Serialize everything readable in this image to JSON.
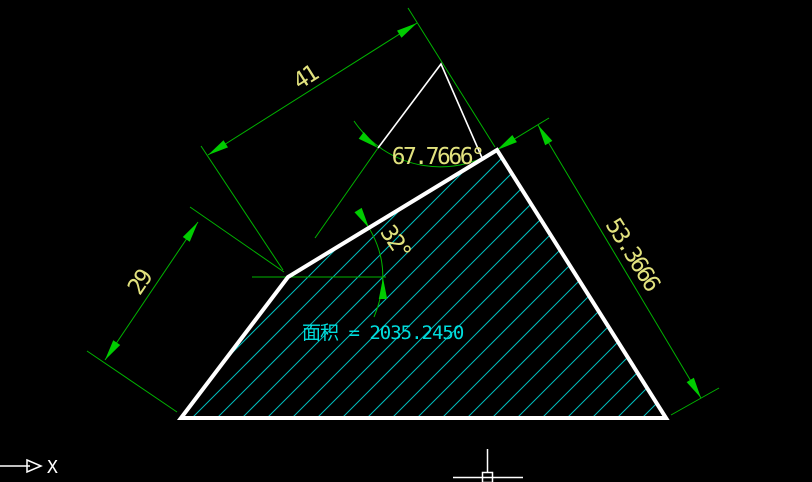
{
  "app": {
    "type": "cad-drawing-view",
    "background": "#000000"
  },
  "drawing": {
    "shape": "hatched quadrilateral polygon",
    "dimensions": {
      "length_top": {
        "value": "41"
      },
      "length_left": {
        "value": "29"
      },
      "length_right": {
        "value": "53.3666"
      },
      "angle_upper": {
        "value": "67.7666°"
      },
      "angle_lower": {
        "value": "32°"
      }
    },
    "area_label": {
      "text": "面积 = 2035.2450"
    },
    "colors": {
      "dimension_line": "#00b400",
      "arrowhead": "#00cc00",
      "dimension_text": "#e2e27e",
      "hatch": "#00bebe",
      "outline": "#ffffff",
      "area_text": "#00dcdc"
    }
  },
  "ucs_icon": {
    "x_axis_label": "X"
  }
}
